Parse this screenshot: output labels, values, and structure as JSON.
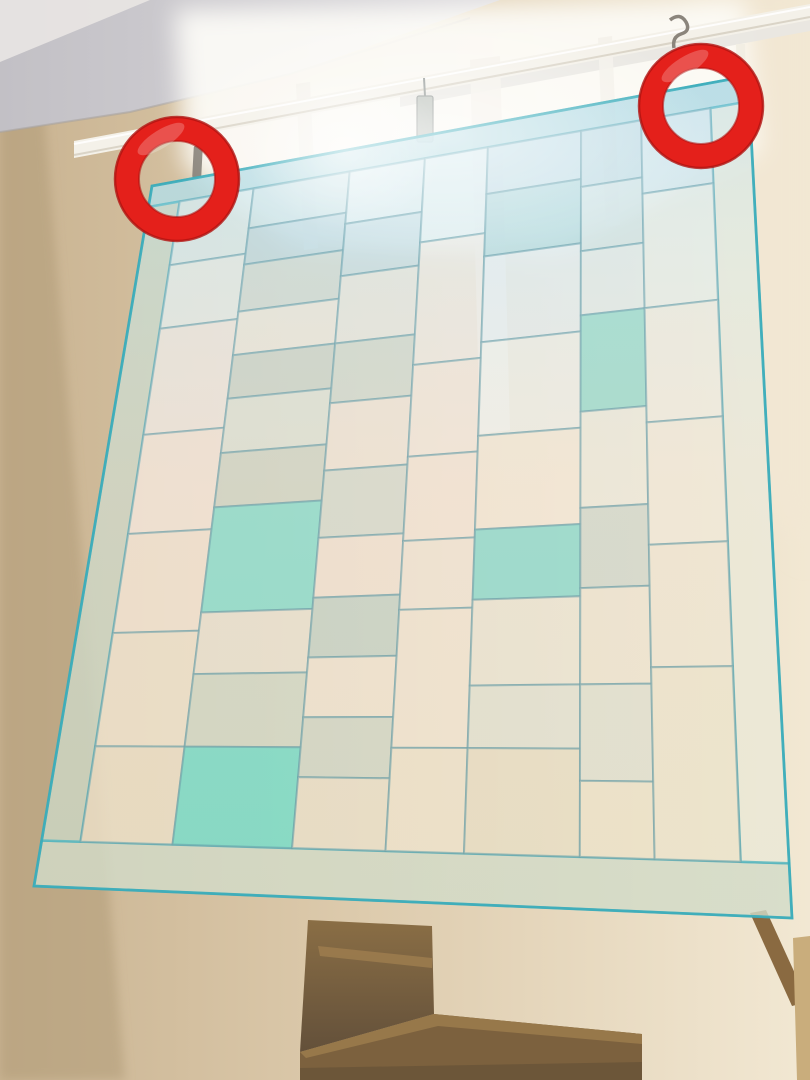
{
  "scene": {
    "description": "Photograph looking up a stairwell: a sheer pojagi-style patchwork curtain hangs from a white rod in front of a bright window; two red ring annotations mark the left and right hanging hooks; wooden stairs are visible below the curtain hem.",
    "width": 810,
    "height": 1080
  },
  "palette": {
    "wall_left": "#c9b391",
    "wall_mid": "#ddcbad",
    "wall_right": "#f2e8d3",
    "wall_shadow": "#b19b79",
    "ceiling_dark": "#c2c0c5",
    "ceiling_light": "#dcdade",
    "ceiling_corner": "#e9e6e3",
    "window_light": "#fdfcf7",
    "frame_white": "#f4f1ea",
    "frame_gray": "#e9e7e2",
    "rod_white": "#f4f1e9",
    "rod_shadow": "#cfc8b8",
    "rod_highlight": "#ffffff",
    "clip_gray": "#b9bfb8",
    "clip_dark": "#8d9390",
    "hook_metal": "#8b857c",
    "cord_white": "#f1ede2",
    "wood_top": "#8a6e45",
    "wood_dark": "#63503a",
    "wood_mid": "#7c613e",
    "wood_beam_top": "#97784a",
    "wood_beam_shadow": "#6a5538",
    "wood_step_light": "#9b7b4e",
    "wood_rail": "#8a6a41",
    "wood_trim": "#c9ad7c"
  },
  "annotations": {
    "ring_color": "#e4201b",
    "ring_edge_color": "#b01310",
    "ring_radius": 50,
    "ring_stroke_width": 24,
    "rings": [
      {
        "cx": 177,
        "cy": 179
      },
      {
        "cx": 701,
        "cy": 106
      }
    ]
  },
  "curtain": {
    "quad": [
      [
        152,
        186
      ],
      [
        748,
        76
      ],
      [
        792,
        918
      ],
      [
        34,
        886
      ]
    ],
    "patch_opacity": 0.78,
    "seam": {
      "color": "#54919e",
      "width": 2,
      "opacity": 0.55
    },
    "border_seam": {
      "color": "#3aacba",
      "width": 2.5,
      "opacity": 0.8
    },
    "patches": [
      {
        "u": [
          0,
          1
        ],
        "v": [
          0,
          0.03
        ],
        "c": "#a4d4da",
        "b": true
      },
      {
        "u": [
          0,
          1
        ],
        "v": [
          0.935,
          1
        ],
        "c": "#cbd8c6",
        "b": true
      },
      {
        "u": [
          0,
          0.052
        ],
        "v": [
          0.03,
          0.935
        ],
        "c": "#c1d2c0",
        "b": true
      },
      {
        "u": [
          0.935,
          1
        ],
        "v": [
          0.03,
          0.935
        ],
        "c": "#e8e9d8",
        "b": true
      },
      {
        "u": [
          0.052,
          0.175
        ],
        "v": [
          0.03,
          0.12
        ],
        "c": "#d8eaec"
      },
      {
        "u": [
          0.052,
          0.175
        ],
        "v": [
          0.12,
          0.21
        ],
        "c": "#e6edea"
      },
      {
        "u": [
          0.052,
          0.175
        ],
        "v": [
          0.21,
          0.36
        ],
        "c": "#efe8e1"
      },
      {
        "u": [
          0.052,
          0.175
        ],
        "v": [
          0.36,
          0.5
        ],
        "c": "#f3e7db"
      },
      {
        "u": [
          0.052,
          0.175
        ],
        "v": [
          0.5,
          0.64
        ],
        "c": "#f2e4d4"
      },
      {
        "u": [
          0.052,
          0.175
        ],
        "v": [
          0.64,
          0.8
        ],
        "c": "#eee3cd"
      },
      {
        "u": [
          0.052,
          0.175
        ],
        "v": [
          0.8,
          0.935
        ],
        "c": "#eadfc6"
      },
      {
        "u": [
          0.175,
          0.335
        ],
        "v": [
          0.03,
          0.085
        ],
        "c": "#c8e1e6"
      },
      {
        "u": [
          0.175,
          0.335
        ],
        "v": [
          0.085,
          0.135
        ],
        "c": "#b7d5de"
      },
      {
        "u": [
          0.175,
          0.335
        ],
        "v": [
          0.135,
          0.2
        ],
        "c": "#cbd9d3"
      },
      {
        "u": [
          0.175,
          0.335
        ],
        "v": [
          0.2,
          0.26
        ],
        "c": "#ede9df"
      },
      {
        "u": [
          0.175,
          0.335
        ],
        "v": [
          0.26,
          0.32
        ],
        "c": "#c3d1c8"
      },
      {
        "u": [
          0.175,
          0.335
        ],
        "v": [
          0.32,
          0.395
        ],
        "c": "#dae3d8"
      },
      {
        "u": [
          0.175,
          0.335
        ],
        "v": [
          0.395,
          0.47
        ],
        "c": "#c8d3c5"
      },
      {
        "u": [
          0.175,
          0.335
        ],
        "v": [
          0.47,
          0.615
        ],
        "c": "#79dbcb",
        "o": 0.88
      },
      {
        "u": [
          0.175,
          0.335
        ],
        "v": [
          0.615,
          0.7
        ],
        "c": "#e8e3d3"
      },
      {
        "u": [
          0.175,
          0.335
        ],
        "v": [
          0.7,
          0.8
        ],
        "c": "#cbd7c7"
      },
      {
        "u": [
          0.175,
          0.335
        ],
        "v": [
          0.8,
          0.935
        ],
        "c": "#69d8c5",
        "o": 0.9
      },
      {
        "u": [
          0.335,
          0.46
        ],
        "v": [
          0.03,
          0.1
        ],
        "c": "#daecef"
      },
      {
        "u": [
          0.335,
          0.46
        ],
        "v": [
          0.1,
          0.17
        ],
        "c": "#c2dbe3"
      },
      {
        "u": [
          0.335,
          0.46
        ],
        "v": [
          0.17,
          0.26
        ],
        "c": "#e7e8e1"
      },
      {
        "u": [
          0.335,
          0.46
        ],
        "v": [
          0.26,
          0.34
        ],
        "c": "#cbd7cd"
      },
      {
        "u": [
          0.335,
          0.46
        ],
        "v": [
          0.34,
          0.43
        ],
        "c": "#f0e5d9"
      },
      {
        "u": [
          0.335,
          0.46
        ],
        "v": [
          0.43,
          0.52
        ],
        "c": "#cedacf"
      },
      {
        "u": [
          0.335,
          0.46
        ],
        "v": [
          0.52,
          0.6
        ],
        "c": "#f1e3d5"
      },
      {
        "u": [
          0.335,
          0.46
        ],
        "v": [
          0.6,
          0.68
        ],
        "c": "#bbcfc7"
      },
      {
        "u": [
          0.335,
          0.46
        ],
        "v": [
          0.68,
          0.76
        ],
        "c": "#f0e6d4"
      },
      {
        "u": [
          0.335,
          0.46
        ],
        "v": [
          0.76,
          0.84
        ],
        "c": "#cad6c8"
      },
      {
        "u": [
          0.335,
          0.46
        ],
        "v": [
          0.84,
          0.935
        ],
        "c": "#e8dfc9"
      },
      {
        "u": [
          0.46,
          0.565
        ],
        "v": [
          0.03,
          0.14
        ],
        "c": "#e2eff1"
      },
      {
        "u": [
          0.46,
          0.565
        ],
        "v": [
          0.14,
          0.3
        ],
        "c": "#f1ebe3"
      },
      {
        "u": [
          0.46,
          0.565
        ],
        "v": [
          0.3,
          0.42
        ],
        "c": "#f4e8dc"
      },
      {
        "u": [
          0.46,
          0.565
        ],
        "v": [
          0.42,
          0.53
        ],
        "c": "#f3e5d7"
      },
      {
        "u": [
          0.46,
          0.565
        ],
        "v": [
          0.53,
          0.62
        ],
        "c": "#f0e6d6"
      },
      {
        "u": [
          0.46,
          0.565
        ],
        "v": [
          0.62,
          0.8
        ],
        "c": "#f1e6d3"
      },
      {
        "u": [
          0.46,
          0.565
        ],
        "v": [
          0.8,
          0.935
        ],
        "c": "#ede3cc"
      },
      {
        "u": [
          0.565,
          0.72
        ],
        "v": [
          0.03,
          0.09
        ],
        "c": "#c1dce5"
      },
      {
        "u": [
          0.565,
          0.72
        ],
        "v": [
          0.09,
          0.17
        ],
        "c": "#a6d3d7"
      },
      {
        "u": [
          0.565,
          0.72
        ],
        "v": [
          0.17,
          0.28
        ],
        "c": "#e5edef"
      },
      {
        "u": [
          0.565,
          0.72
        ],
        "v": [
          0.28,
          0.4
        ],
        "c": "#eeefe9"
      },
      {
        "u": [
          0.565,
          0.72
        ],
        "v": [
          0.4,
          0.52
        ],
        "c": "#f3e9d7"
      },
      {
        "u": [
          0.565,
          0.72
        ],
        "v": [
          0.52,
          0.61
        ],
        "c": "#7dd7cb",
        "o": 0.88
      },
      {
        "u": [
          0.565,
          0.72
        ],
        "v": [
          0.61,
          0.72
        ],
        "c": "#e9e5d5"
      },
      {
        "u": [
          0.565,
          0.72
        ],
        "v": [
          0.72,
          0.8
        ],
        "c": "#dee1d3"
      },
      {
        "u": [
          0.565,
          0.72
        ],
        "v": [
          0.8,
          0.935
        ],
        "c": "#e6dcc3"
      },
      {
        "u": [
          0.72,
          0.82
        ],
        "v": [
          0.03,
          0.1
        ],
        "c": "#bbd7df"
      },
      {
        "u": [
          0.72,
          0.82
        ],
        "v": [
          0.1,
          0.18
        ],
        "c": "#cfe1e1"
      },
      {
        "u": [
          0.72,
          0.82
        ],
        "v": [
          0.18,
          0.26
        ],
        "c": "#e2ebe9"
      },
      {
        "u": [
          0.72,
          0.82
        ],
        "v": [
          0.26,
          0.38
        ],
        "c": "#8bd7c7",
        "o": 0.88
      },
      {
        "u": [
          0.72,
          0.82
        ],
        "v": [
          0.38,
          0.5
        ],
        "c": "#ebeadd"
      },
      {
        "u": [
          0.72,
          0.82
        ],
        "v": [
          0.5,
          0.6
        ],
        "c": "#c8d5cb"
      },
      {
        "u": [
          0.72,
          0.82
        ],
        "v": [
          0.6,
          0.72
        ],
        "c": "#ece4d1"
      },
      {
        "u": [
          0.72,
          0.82
        ],
        "v": [
          0.72,
          0.84
        ],
        "c": "#dbdfd1"
      },
      {
        "u": [
          0.72,
          0.82
        ],
        "v": [
          0.84,
          0.935
        ],
        "c": "#ebe1c8"
      },
      {
        "u": [
          0.82,
          0.935
        ],
        "v": [
          0.03,
          0.12
        ],
        "c": "#d2e5ea"
      },
      {
        "u": [
          0.82,
          0.935
        ],
        "v": [
          0.12,
          0.26
        ],
        "c": "#eaeee7"
      },
      {
        "u": [
          0.82,
          0.935
        ],
        "v": [
          0.26,
          0.4
        ],
        "c": "#f0ecdf"
      },
      {
        "u": [
          0.82,
          0.935
        ],
        "v": [
          0.4,
          0.55
        ],
        "c": "#efe9d8"
      },
      {
        "u": [
          0.82,
          0.935
        ],
        "v": [
          0.55,
          0.7
        ],
        "c": "#ede6d1"
      },
      {
        "u": [
          0.82,
          0.935
        ],
        "v": [
          0.7,
          0.935
        ],
        "c": "#ebe3cb"
      }
    ]
  }
}
